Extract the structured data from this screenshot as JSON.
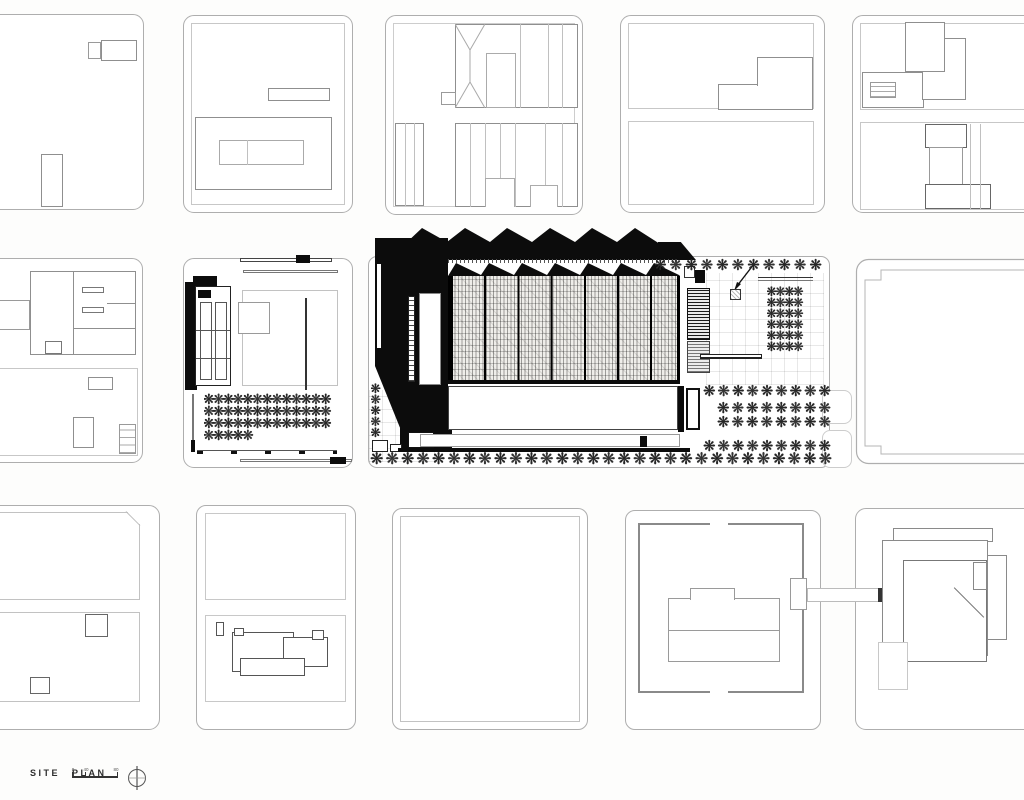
{
  "plan": {
    "title": "SITE PLAN",
    "scale_bar": {
      "t0": "0",
      "t1": "40",
      "t2": "80"
    },
    "glyphs": {
      "tree": "❋",
      "north": "north-arrow"
    },
    "colors": {
      "ink": "#0c0c0c",
      "block_outline": "#aeaeae",
      "tree": "#262626"
    },
    "tree_groups": [
      {
        "target": "trees-row-central-top",
        "count": 11,
        "size": 15
      },
      {
        "target": "trees-row-street-south",
        "count": 30,
        "size": 16
      },
      {
        "target": "trees-row-parking-1",
        "count": 9,
        "size": 15
      },
      {
        "target": "trees-row-parking-2",
        "count": 8,
        "size": 15
      },
      {
        "target": "trees-row-parking-3",
        "count": 8,
        "size": 15
      },
      {
        "target": "trees-row-parking-4",
        "count": 9,
        "size": 15
      },
      {
        "target": "grove-plaza",
        "count": 24,
        "size": 13
      },
      {
        "target": "grove-west-block",
        "count": 44,
        "size": 14
      },
      {
        "target": "trees-col-west-edge",
        "count": 5,
        "size": 13
      }
    ]
  }
}
